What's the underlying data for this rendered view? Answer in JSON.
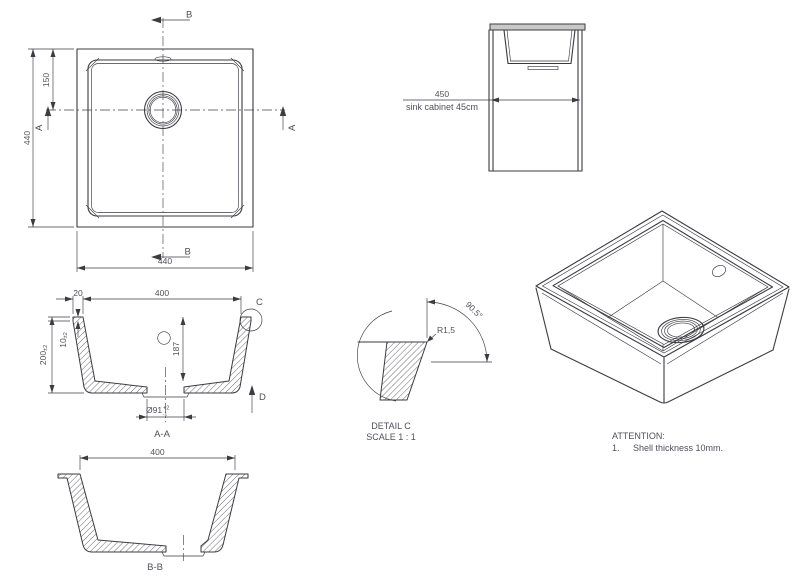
{
  "drawing": {
    "colors": {
      "line": "#3b3b42",
      "text": "#50505a",
      "countertop_fill": "#c8c8c8"
    },
    "top_view": {
      "section_b": "B",
      "section_a": "A",
      "dim_height": "440",
      "dim_drain_offset": "150",
      "dim_width": "440"
    },
    "cabinet_view": {
      "dim_width": "450",
      "caption": "sink cabinet 45cm"
    },
    "section_aa": {
      "label": "A-A",
      "dim_inner_width": "400",
      "dim_rim_width": "20",
      "dim_rim_thickness": "10",
      "dim_rim_thickness_tol": "±2",
      "dim_depth": "200",
      "dim_depth_tol": "±2",
      "dim_inner_depth": "187",
      "dim_drain_dia": "Ø91",
      "dim_drain_tol_plus": "+2",
      "dim_drain_tol_minus": "-1",
      "detail_ref": "C",
      "view_ref": "D"
    },
    "detail_c": {
      "title": "DETAIL C",
      "scale": "SCALE 1 : 1",
      "radius": "R1,5",
      "angle": "90.5°"
    },
    "section_bb": {
      "label": "B-B",
      "dim_inner_width": "400"
    },
    "notes": {
      "title": "ATTENTION:",
      "item_number": "1.",
      "item_text": "Shell thickness 10mm."
    }
  }
}
